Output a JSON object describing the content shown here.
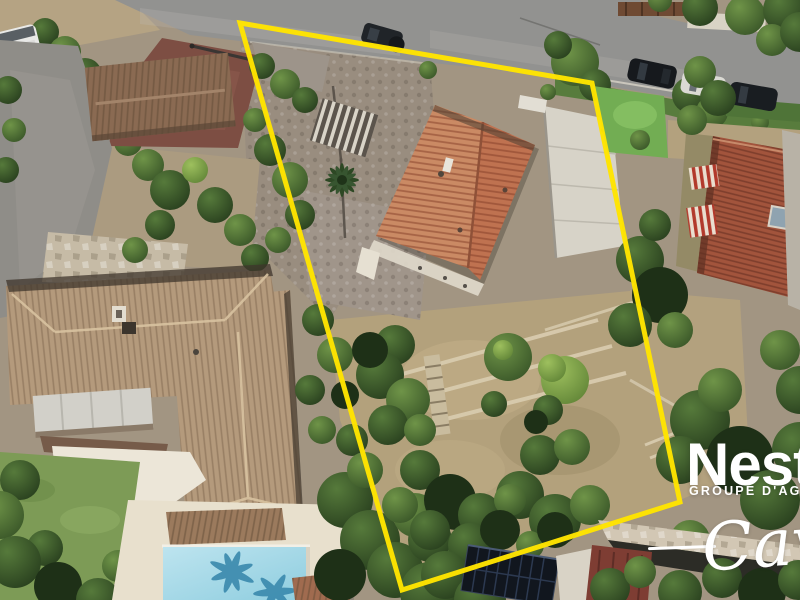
{
  "image": {
    "type": "aerial-drone-photo",
    "subject": "residential property for sale with plot boundary overlay"
  },
  "boundary": {
    "name": "property-boundary",
    "points": "240,23 592,83 680,502 402,590",
    "color": "#FFE400",
    "stroke_width": 5
  },
  "watermark": {
    "brand": "Nest",
    "subtitle": "GROUPE D'AGENC",
    "signature": "Cava",
    "color": "#FFFFFF"
  },
  "scene": {
    "objects": [
      "top-road",
      "parked-cars",
      "white-van",
      "motorbike",
      "brown-fence",
      "flower-hedge",
      "red-driveway",
      "left-neighbor-house",
      "awning",
      "white-terrace",
      "lawn",
      "swimming-pool",
      "pool-deck",
      "subject-house",
      "pergola",
      "palm-tree",
      "white-concrete-slab",
      "cobble-courtyard",
      "terraced-garden",
      "garden-steps",
      "dry-lawn",
      "garden-trees",
      "artificial-turf",
      "right-neighbor-house",
      "striped-awnings",
      "skylight",
      "solar-panels",
      "stone-path",
      "red-roof-building"
    ],
    "colors": {
      "road_gray": "#939390",
      "dirt_tan": "#B3A27D",
      "subject_roof_left": "#CA8A64",
      "subject_roof_right": "#BF7250",
      "neighbor_roof_tan": "#B49A7C",
      "right_roof_red": "#A2543C",
      "pool_blue": "#A6D8E8",
      "lawn_green": "#7D9B56",
      "turf_green": "#72AD53",
      "tree_dark_green": "#2E4724",
      "solar_panel": "#141C26",
      "red_driveway": "#7D4E43",
      "concrete_white": "#D7D3C8"
    }
  }
}
